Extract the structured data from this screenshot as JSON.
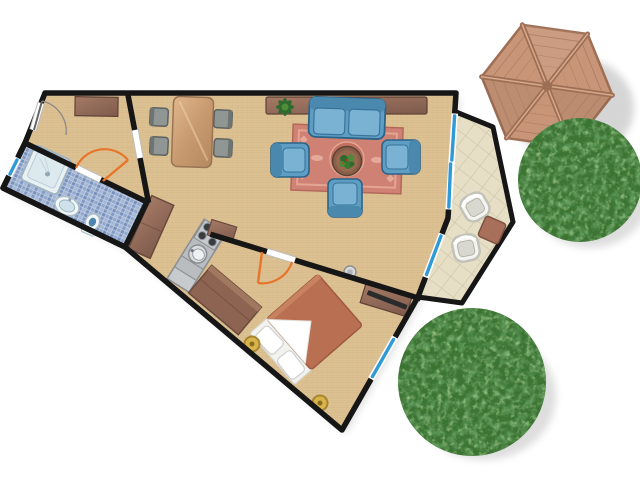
{
  "meta": {
    "description": "Top-down architectural floor plan of a small apartment with attached terrace, wooden gazebo and two trees",
    "style": "color illustration, no text labels"
  },
  "palette": {
    "wall": "#161616",
    "floor_tan": "#dcc192",
    "bathroom_tile_blue": "#8fa7cd",
    "terrace_tile": "#e6dfc6",
    "sofa_blue": "#5e9ec4",
    "sofa_cushion": "#79b2d2",
    "rug_salmon": "#cf8274",
    "wood_brown": "#9b7361",
    "bed_terracotta": "#b96f52",
    "door_swing_orange": "#e8762a",
    "slider_blue": "#2f9ad8",
    "tree_green": "#3c7433",
    "gazebo_wood": "#c89578",
    "stainless": "#b9bdc0",
    "stool_gold": "#d9b44a"
  },
  "rooms": [
    {
      "id": "entry-hall",
      "label": "Entry Hall",
      "furniture": [
        {
          "item": "entrance-door",
          "type": "hinged-swing"
        },
        {
          "item": "console-cabinet"
        }
      ]
    },
    {
      "id": "bathroom",
      "label": "Bathroom",
      "floor": "blue-mosaic",
      "furniture": [
        {
          "item": "shower-tray"
        },
        {
          "item": "washbasin"
        },
        {
          "item": "toilet"
        }
      ],
      "window": "small-sliding"
    },
    {
      "id": "living-dining",
      "label": "Living / Dining Room",
      "furniture": [
        {
          "item": "dining-table"
        },
        {
          "item": "dining-chair",
          "count": 4
        },
        {
          "item": "sideboard"
        },
        {
          "item": "potted-plant"
        },
        {
          "item": "sofa",
          "seats": 2
        },
        {
          "item": "armchair",
          "count": 3
        },
        {
          "item": "round-coffee-table"
        },
        {
          "item": "ornamental-rug"
        },
        {
          "item": "wall-light"
        }
      ]
    },
    {
      "id": "kitchen",
      "label": "Kitchen corridor",
      "furniture": [
        {
          "item": "kitchen-counter"
        },
        {
          "item": "round-sink"
        },
        {
          "item": "stove",
          "burners": 4
        },
        {
          "item": "end-cabinet"
        },
        {
          "item": "hall-wardrobe"
        }
      ]
    },
    {
      "id": "bedroom",
      "label": "Bedroom",
      "furniture": [
        {
          "item": "double-bed"
        },
        {
          "item": "pillow",
          "count": 2
        },
        {
          "item": "bedside-stool",
          "count": 2
        },
        {
          "item": "wardrobe"
        },
        {
          "item": "dresser-with-tv"
        }
      ]
    },
    {
      "id": "terrace",
      "label": "Terrace",
      "floor": "diagonal-stone-tiles",
      "furniture": [
        {
          "item": "patio-chair",
          "count": 2
        },
        {
          "item": "patio-side-table"
        }
      ]
    }
  ],
  "openings": {
    "entrance_door": "hinged, grey swing arc",
    "bathroom_door": "hinged, orange swing arc",
    "bedroom_door": "hinged, orange swing arc",
    "living_terrace_slider": "sliding glass door, blue",
    "mid_window": "sliding window, blue",
    "bedroom_window": "sliding window, blue",
    "bathroom_window": "small window, blue"
  },
  "outdoor": [
    {
      "item": "gazebo-roof",
      "shape": "hexagonal",
      "spokes": 6,
      "material": "wood planks"
    },
    {
      "item": "round-tree",
      "count": 2
    }
  ]
}
